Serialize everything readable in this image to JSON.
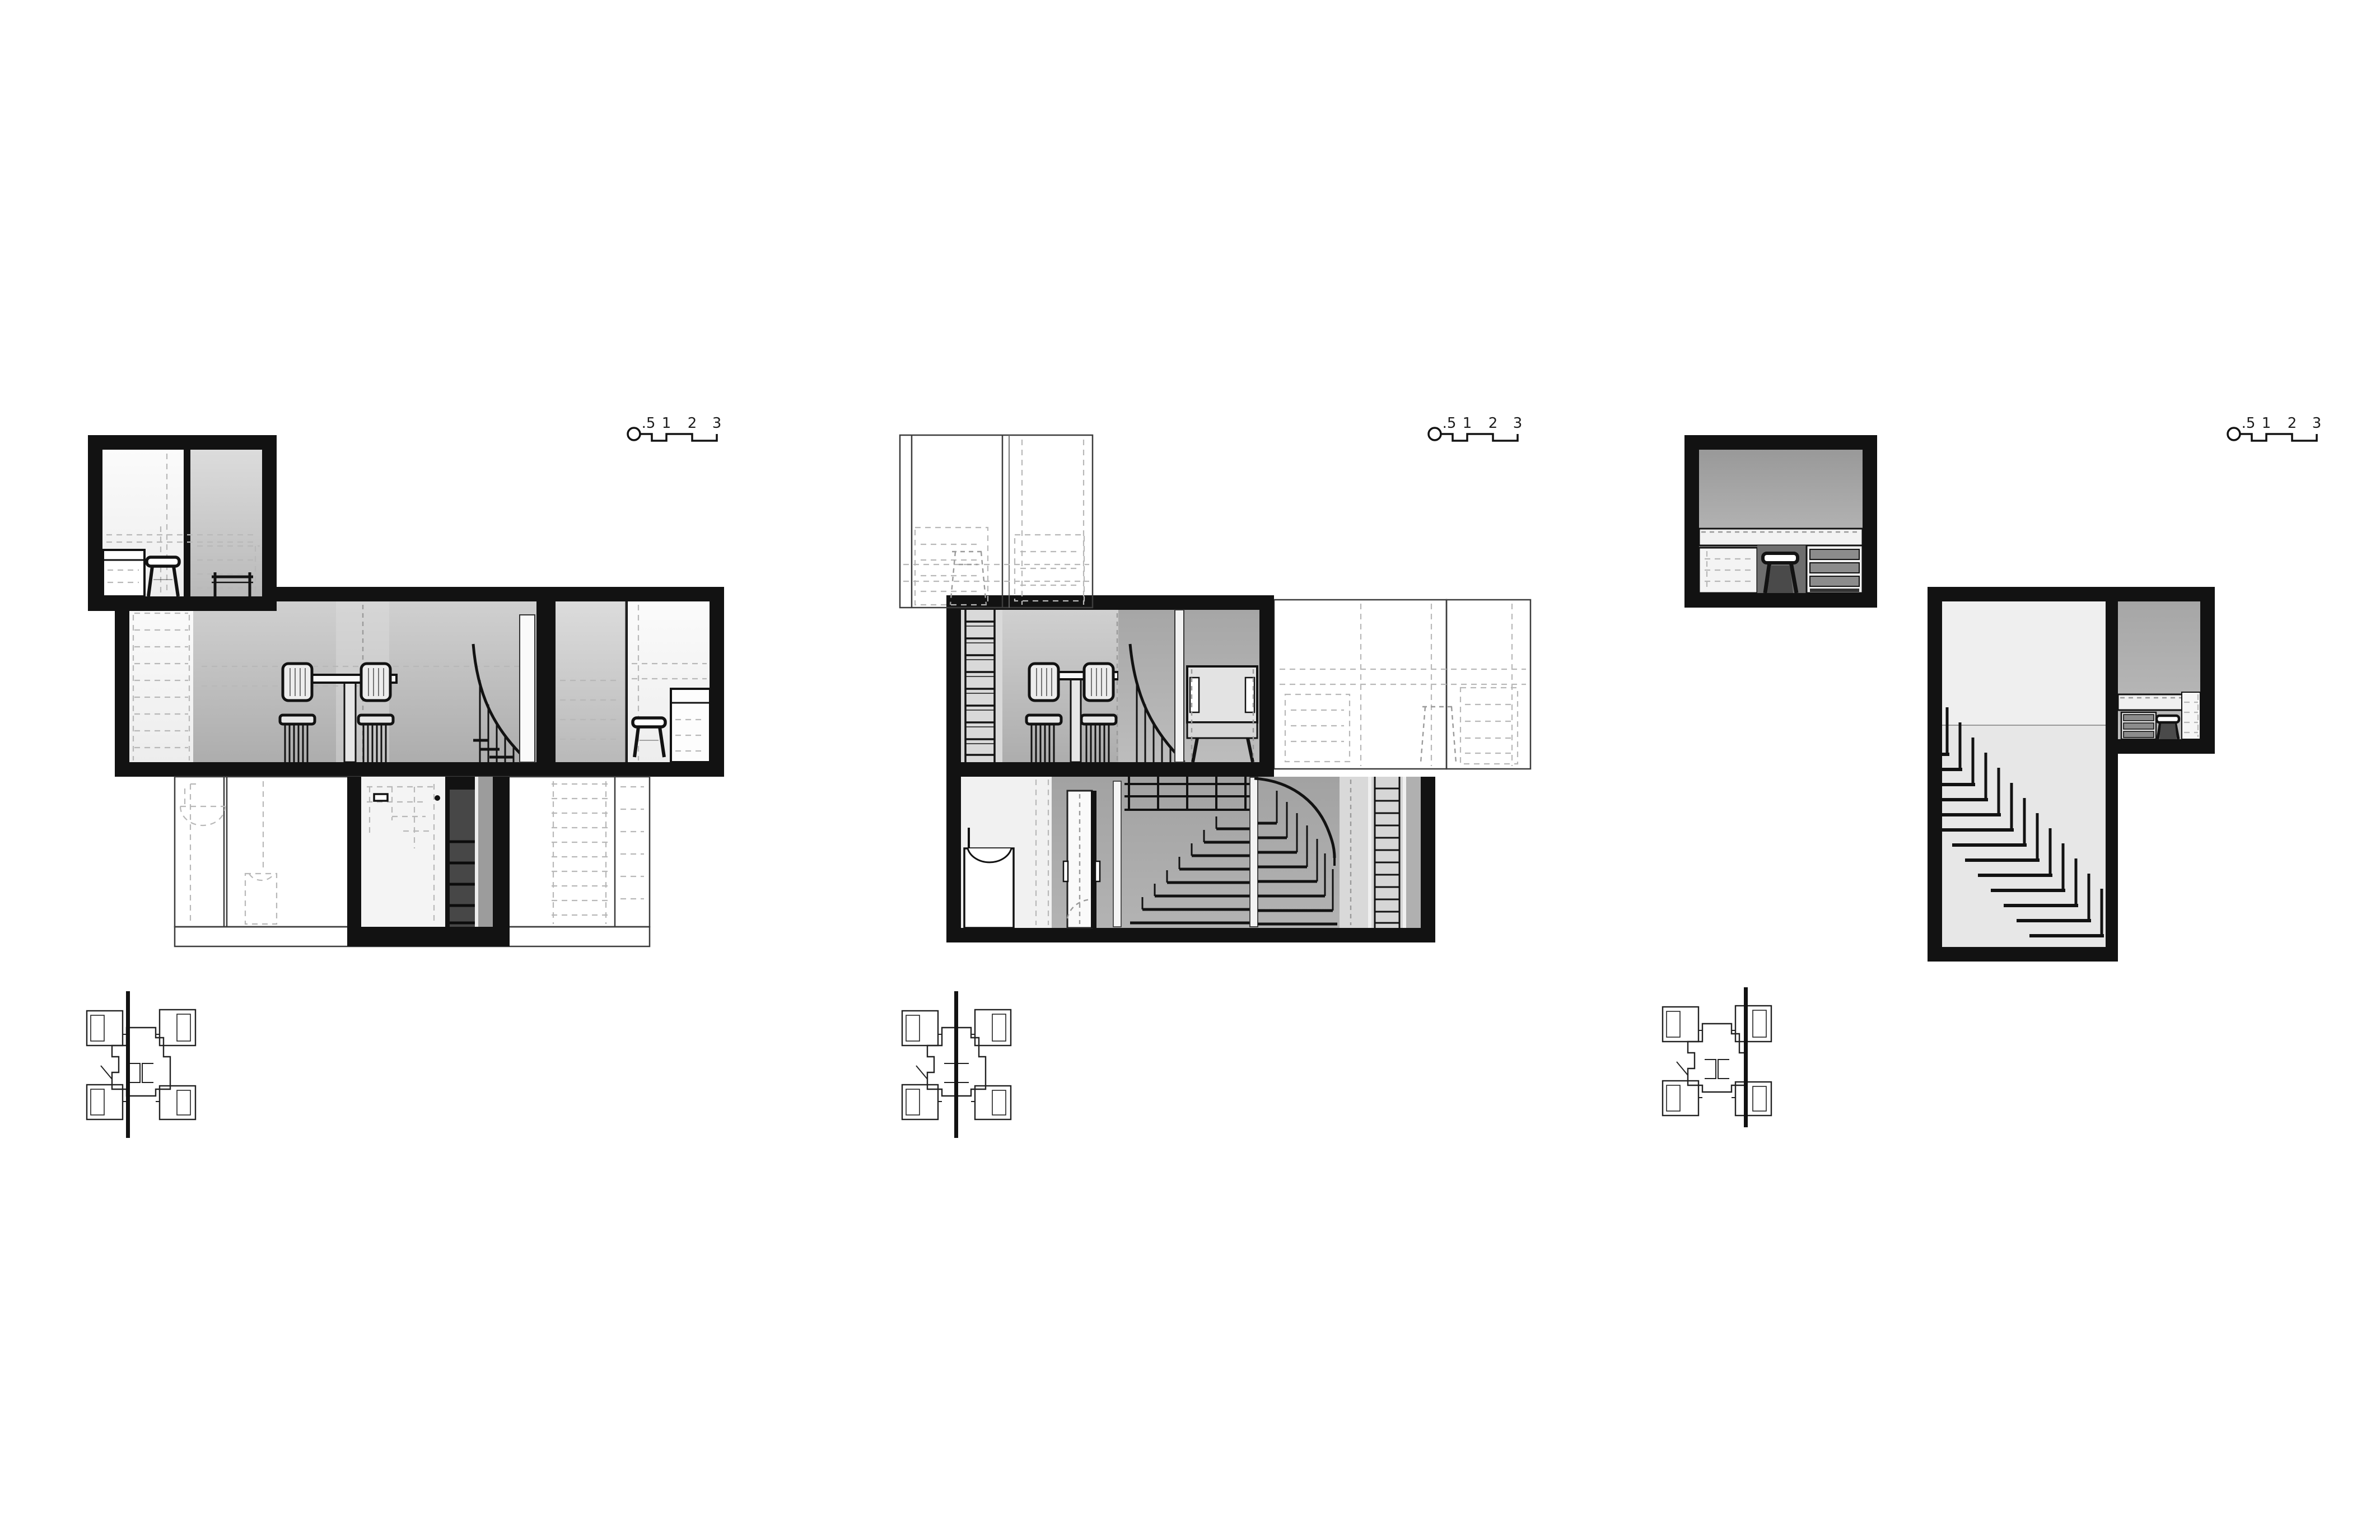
{
  "page": {
    "title": "Housing unit cross sections",
    "background": "#ffffff",
    "drawing_count": 3
  },
  "scale_bar": {
    "labels": [
      ".5",
      "1",
      "2",
      "3"
    ],
    "unit_hint": "meters"
  },
  "panels": [
    {
      "id": "section-1",
      "name": "Cross section 1",
      "key_plan_cut_position": "left",
      "features": [
        "upper bedroom box",
        "living level with dining table, chairs and spiral stair",
        "lower level with dark stair shaft and bathroom elevations"
      ]
    },
    {
      "id": "section-2",
      "name": "Cross section 2",
      "key_plan_cut_position": "center",
      "features": [
        "living level with ladder, dining table, spiral stair and armchair",
        "lower level with door, spiral stair fan and ladder",
        "dashed elevation boxes"
      ]
    },
    {
      "id": "section-3",
      "name": "Cross section 3",
      "key_plan_cut_position": "right",
      "features": [
        "small studio box with workbench, stool and drawers",
        "double-height stair box with cantilevered treads",
        "upper work room with counter"
      ]
    }
  ],
  "colors": {
    "poche": "#121212",
    "background": "#ffffff",
    "room_light": "#f0f0f0",
    "room_gray_light": "#c9c9c9",
    "room_gray_mid": "#b0b0b0",
    "room_gray_dark": "#9b9b9b",
    "hidden_line": "#b8b8b8",
    "thin_line": "#3c3c3c"
  }
}
